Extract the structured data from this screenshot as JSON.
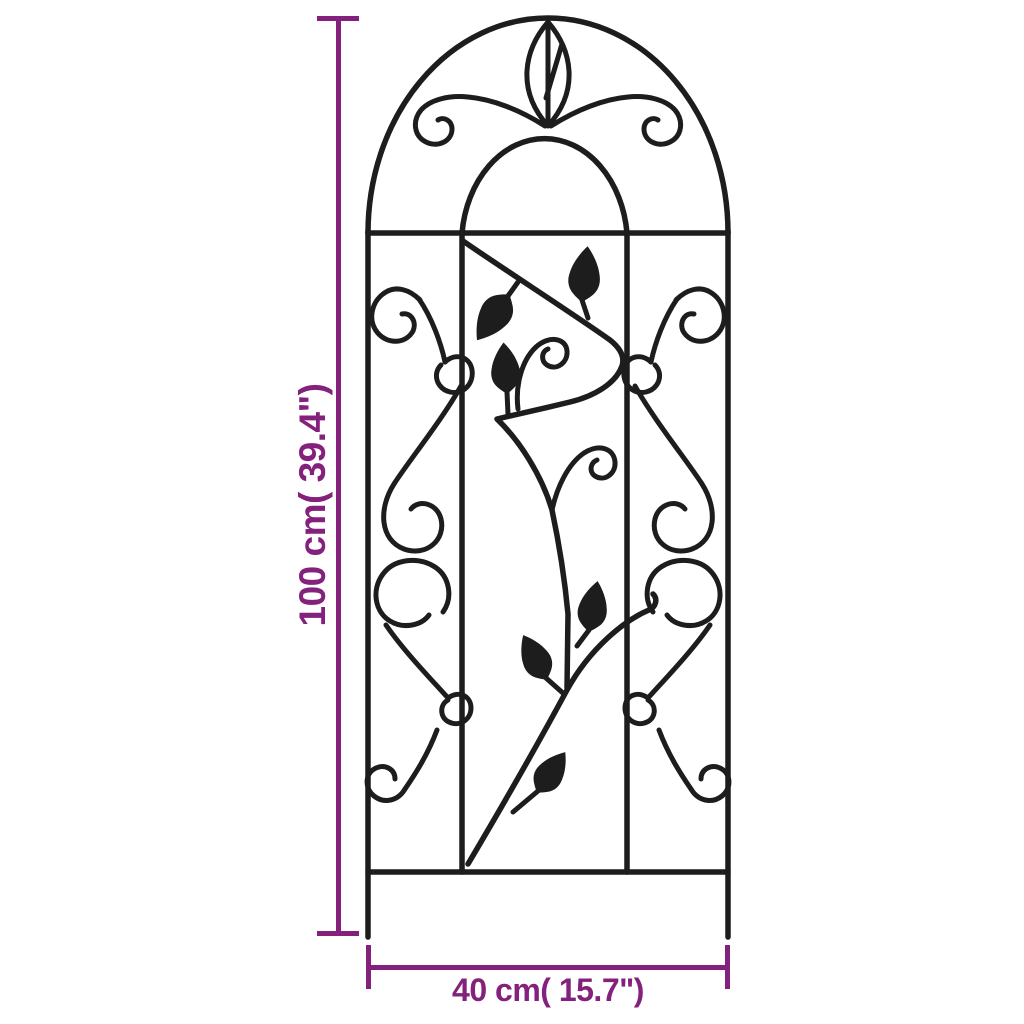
{
  "page": {
    "background_color": "#ffffff"
  },
  "product_diagram": {
    "description": "Arched garden trellis with scrollwork curls and leaf ornaments",
    "line_color": "#1d1d1d"
  },
  "dimensions": {
    "accent_color": "#84217d",
    "height": {
      "label": "100 cm( 39.4\")",
      "value_cm": "100",
      "value_inch": "39.4"
    },
    "width": {
      "label": "40 cm( 15.7\")",
      "value_cm": "40",
      "value_inch": "15.7"
    }
  }
}
